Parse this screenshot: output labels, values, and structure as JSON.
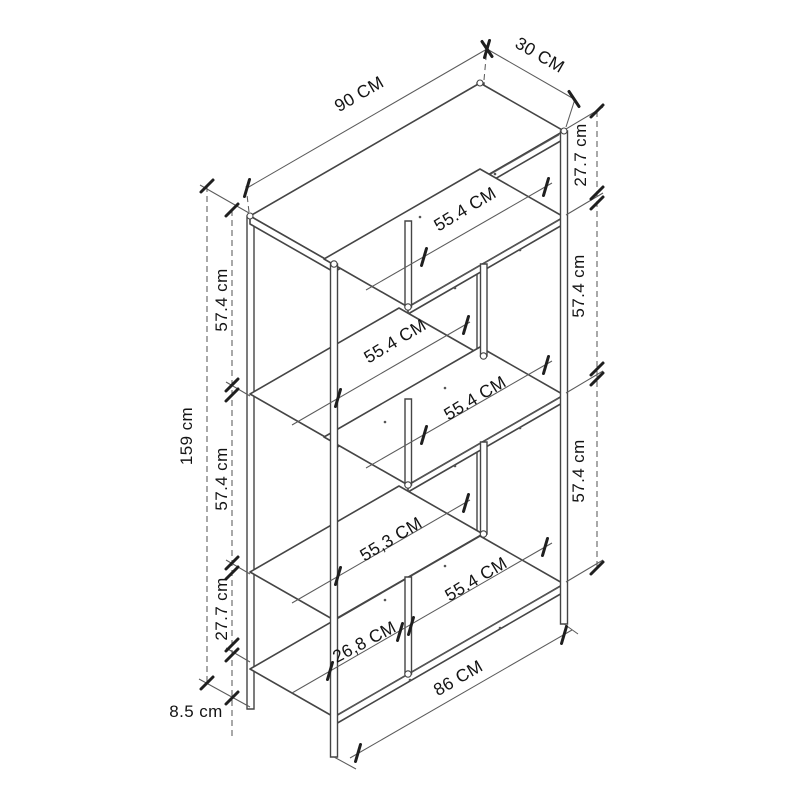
{
  "diagram": {
    "kind": "isometric-furniture-dimension-drawing",
    "subject": "metal frame bookshelf / shelving unit",
    "colors": {
      "background": "#ffffff",
      "structure_line": "#454545",
      "dimension_line": "#5b5b5b",
      "tick": "#1f1f1f",
      "text": "#141414"
    },
    "labels": {
      "top_width": "90 CM",
      "top_depth": "30 CM",
      "right_top_gap": "27.7 cm",
      "right_span_upper": "57.4 cm",
      "right_span_lower": "57.4 cm",
      "left_total_height": "159 cm",
      "left_span_upper": "57.4 cm",
      "left_span_middle": "57.4 cm",
      "left_span_lower": "27.7 cm",
      "left_base_height": "8.5 cm",
      "shelf_right_1": "55.4 CM",
      "shelf_left_1": "55.4 CM",
      "shelf_right_2": "55.4 CM",
      "shelf_left_2": "55,3 CM",
      "bottom_compartment_left": "26,8 CM",
      "bottom_compartment_right": "55.4 CM",
      "bottom_width": "86 CM"
    }
  }
}
